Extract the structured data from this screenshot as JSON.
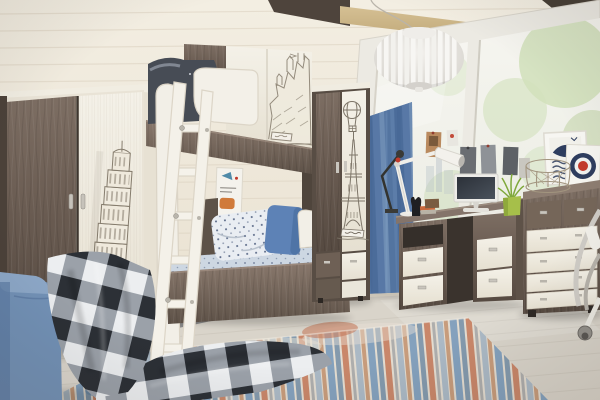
{
  "scene": {
    "title": "Attic kids bedroom with travel-print furniture set: loft bunk bed with ladder, wardrobe with Leaning Tower of Pisa print, tall cabinet with Eiffel Tower and hot-air balloon print, writing desk with lamp and monitor, chest of drawers, blue curtain, slanted roof window, abstract rug and plaid blanket",
    "prints": [
      "leaning-tower-of-pisa",
      "eiffel-tower",
      "hot-air-balloon",
      "castle-sketch"
    ],
    "decor": [
      "whale-nautical-poster",
      "target-roundel-poster",
      "pinned-photos",
      "wire-basket",
      "pendant-lamp",
      "desk-lamp",
      "monitor",
      "plant",
      "area-rug",
      "plaid-blanket",
      "blue-curtain",
      "office-chair"
    ]
  },
  "palette": {
    "wall": "#f3eee2",
    "wall_deep": "#e9e1d1",
    "ceiling_beam": "#d5c094",
    "roof_dark": "#463e35",
    "wood_dark": "#6e6055",
    "wood_dark_deep": "#574b41",
    "wood_dark_light": "#8d7d71",
    "wood_light": "#f2efe6",
    "wood_light_shade": "#ddd6c7",
    "window_glass": "#f6f5f0",
    "foliage": "#c9dcb0",
    "curtain": "#5878a6",
    "curtain_dark": "#4a6b99",
    "curtain_light": "#6f8eb4",
    "bedding_light": "#e9edf2",
    "bedding_dot": "#35476b",
    "pillow_blue": "#5d82b6",
    "mattress": "#cdd7e2",
    "sofa_blue": "#7392b7",
    "sofa_blue_top": "#8da8c8",
    "plaid_dark": "#2c3036",
    "plaid_gray": "#9ba1a9",
    "plaid_light": "#eceef0",
    "floor": "#d9d4ca",
    "rug_base": "#e3dcd0",
    "rug_blue": "#7396ba",
    "rug_steel": "#5c7d9e",
    "rug_rust": "#c06a48",
    "rug_amber": "#b8794f",
    "sketch_ink": "#857c6d",
    "poster_navy": "#2e3d5e",
    "target_red": "#c23a2c",
    "plant_green": "#a6bf4a",
    "lamp_white": "#f7f6f3",
    "metal": "#c6c2ba"
  }
}
